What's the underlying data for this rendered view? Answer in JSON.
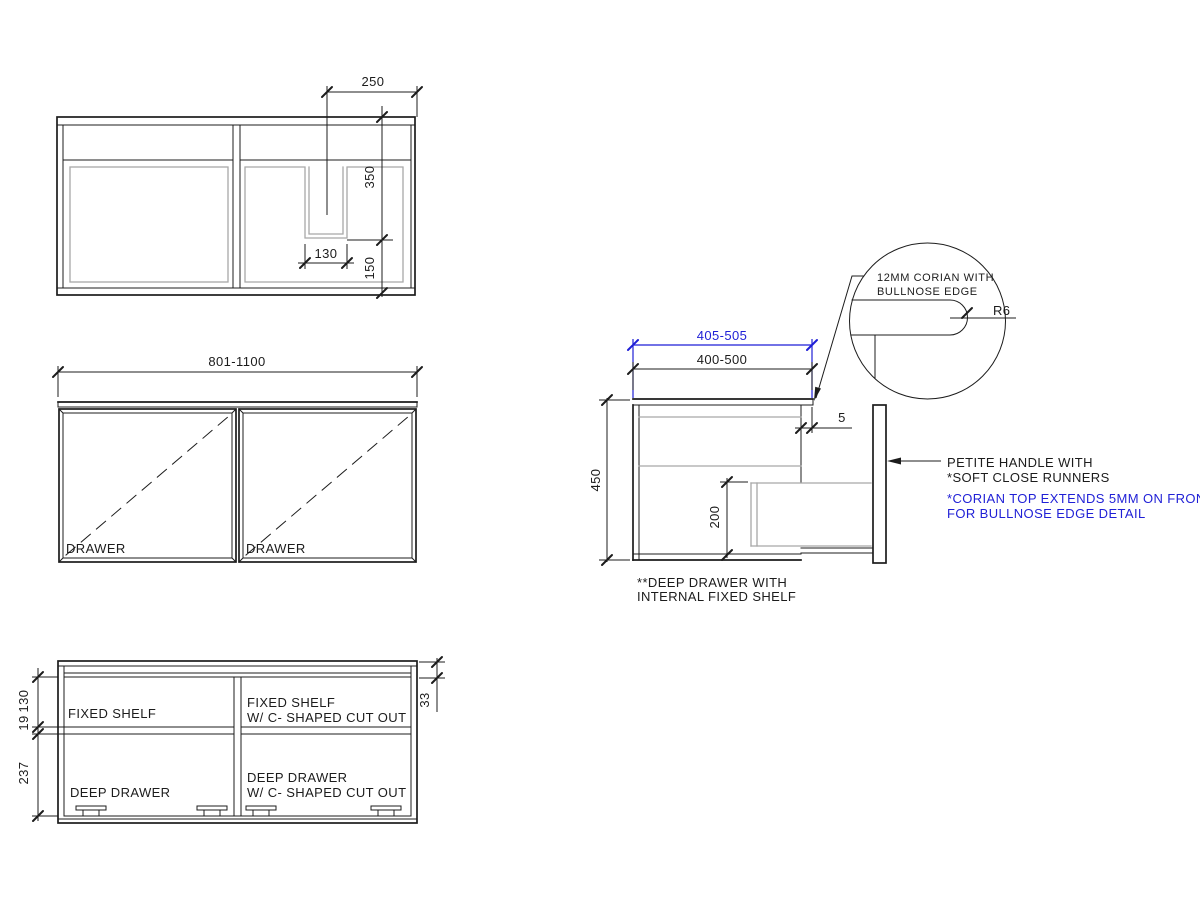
{
  "colors": {
    "line": "#1c1c1c",
    "gray": "#a8a8a8",
    "blue": "#1f1fd6",
    "bg": "#ffffff"
  },
  "plan_view": {
    "dim_cutout_offset": "250",
    "dim_back_to_cutout": "350",
    "dim_cutout_to_front": "150",
    "dim_cutout_width": "130"
  },
  "front_view": {
    "dim_width_range": "801-1100",
    "label_drawer_left": "DRAWER",
    "label_drawer_right": "DRAWER"
  },
  "bottom_view": {
    "dim_top_shelf_space": "130",
    "dim_shelf_thickness": "19",
    "dim_drawer_space": "237",
    "dim_top_thickness": "33",
    "label_fixed_shelf": "FIXED SHELF",
    "label_fixed_shelf_cutout_line1": "FIXED SHELF",
    "label_fixed_shelf_cutout_line2": "W/ C- SHAPED CUT OUT",
    "label_deep_drawer": "DEEP DRAWER",
    "label_deep_drawer_cutout_line1": "DEEP DRAWER",
    "label_deep_drawer_cutout_line2": "W/ C- SHAPED CUT OUT"
  },
  "side_view": {
    "dim_top_depth": "405-505",
    "dim_carcass_depth": "400-500",
    "dim_height": "450",
    "dim_drawer_height": "200",
    "dim_overhang": "5",
    "note_line1": "**DEEP DRAWER WITH",
    "note_line2": "INTERNAL FIXED SHELF"
  },
  "detail_view": {
    "note_line1": "12MM CORIAN WITH",
    "note_line2": "BULLNOSE EDGE",
    "radius_label": "R6"
  },
  "annotations": {
    "handle_note_line1": "PETITE HANDLE WITH",
    "handle_note_line2": "*SOFT CLOSE RUNNERS",
    "corian_note_line1": "*CORIAN TOP EXTENDS 5MM ON FRONT",
    "corian_note_line2": "FOR BULLNOSE EDGE DETAIL"
  }
}
